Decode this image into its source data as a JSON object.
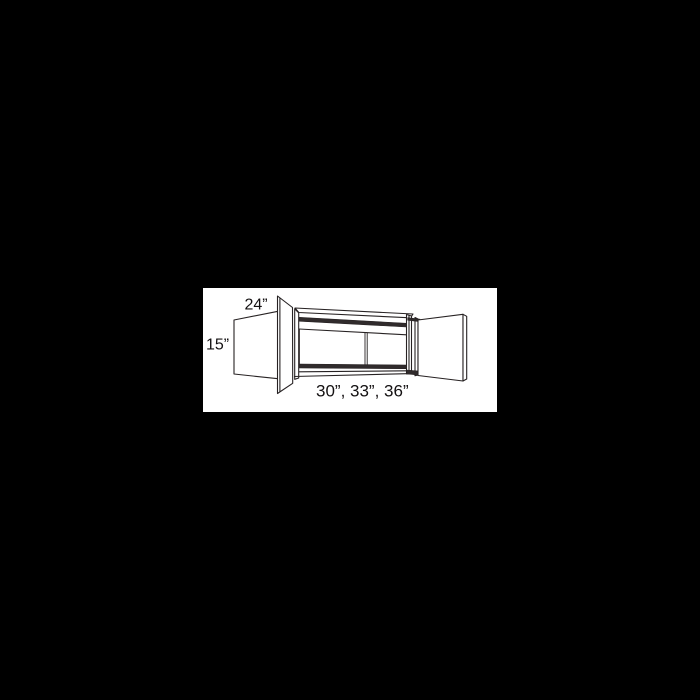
{
  "page": {
    "background_color": "#000000",
    "panel_color": "#ffffff"
  },
  "diagram": {
    "kind": "wall-cabinet-dimension-diagram",
    "description": "Line drawing of a wall cabinet with both doors open, annotated with dimensions",
    "line_color": "#272223",
    "dark_fill": "#302b2c",
    "labels": {
      "depth": "24”",
      "height": "15”",
      "widths": "30”, 33”, 36”"
    }
  }
}
